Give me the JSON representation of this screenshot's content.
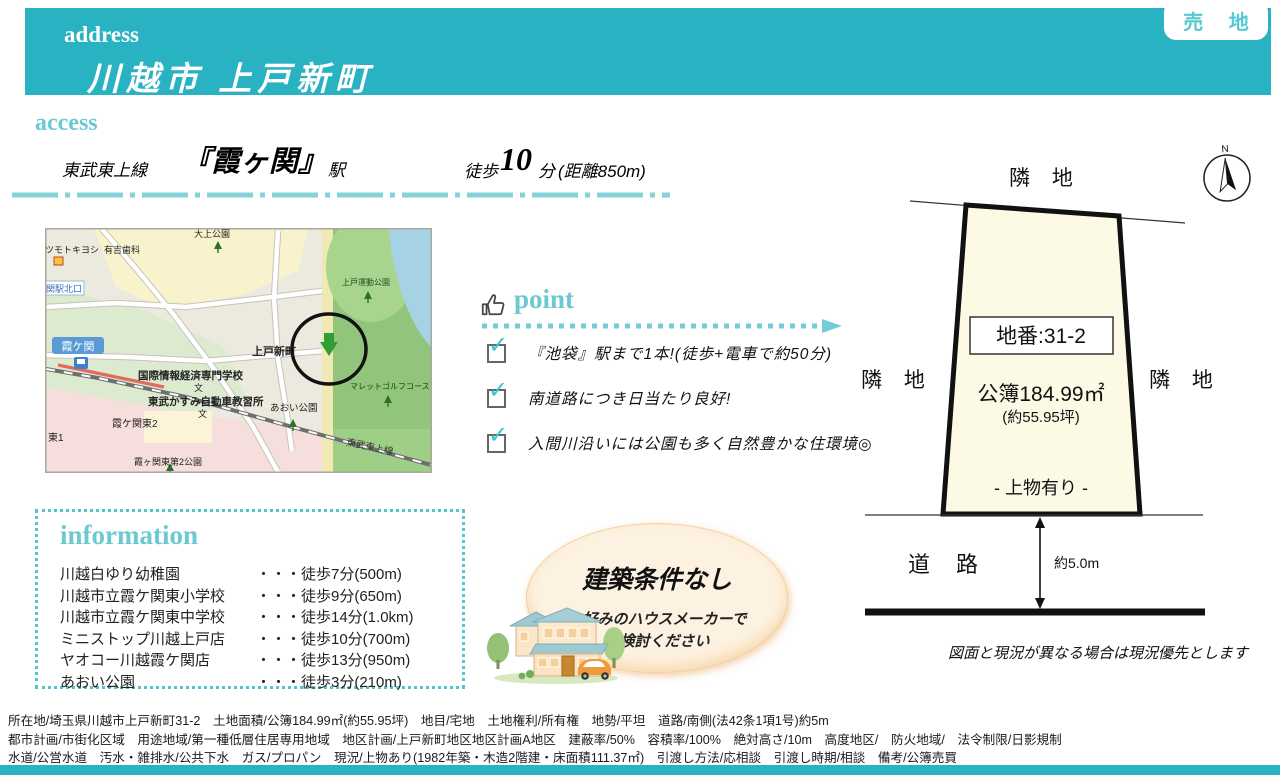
{
  "badge": {
    "text": "売 地"
  },
  "header": {
    "section_label": "address",
    "address": "川越市 上戸新町"
  },
  "access": {
    "section_label": "access",
    "rail_line": "東武東上線",
    "station": "『霞ヶ関』",
    "station_suffix": "駅",
    "walk_prefix": "徒歩",
    "walk_minutes": "10",
    "walk_unit": "分",
    "distance": "(距離850m)"
  },
  "map": {
    "drugstore": "マツモトキヨシ",
    "dental": "有吉歯科",
    "park_daijo": "大上公園",
    "park_sports": "上戸運動公園",
    "station_exit": "関駅北口",
    "station": "霞ケ関",
    "town": "上戸新町",
    "school1": "国際情報経済専門学校",
    "school2": "東武かすみ自動車教習所",
    "area1": "霞ケ関東2",
    "area2": "東1",
    "park_aoi": "あおい公園",
    "golf": "マレットゴルフコース",
    "park_no2": "霞ヶ関東第2公園",
    "rail": "東武東上線",
    "school_mark": "文"
  },
  "point": {
    "section_label": "point",
    "items": [
      "『池袋』駅まで1本!(徒歩+電車で約50分)",
      "南道路につき日当たり良好!",
      "入間川沿いには公園も多く自然豊かな住環境◎"
    ]
  },
  "information": {
    "section_label": "information",
    "items": [
      {
        "name": "川越白ゆり幼稚園",
        "distance": "・・・徒歩7分(500m)"
      },
      {
        "name": "川越市立霞ケ関東小学校",
        "distance": "・・・徒歩9分(650m)"
      },
      {
        "name": "川越市立霞ケ関東中学校",
        "distance": "・・・徒歩14分(1.0km)"
      },
      {
        "name": "ミニストップ川越上戸店",
        "distance": "・・・徒歩10分(700m)"
      },
      {
        "name": "ヤオコー川越霞ケ関店",
        "distance": "・・・徒歩13分(950m)"
      },
      {
        "name": "あおい公園",
        "distance": "・・・徒歩3分(210m)"
      }
    ]
  },
  "highlight": {
    "title": "建築条件なし",
    "subtitle1": "お好みのハウスメーカーで",
    "subtitle2": "ご検討ください"
  },
  "plot": {
    "adjacent_top": "隣 地",
    "adjacent_left": "隣 地",
    "adjacent_right": "隣 地",
    "lot_number": "地番:31-2",
    "area": "公簿184.99㎡",
    "area_tsubo": "(約55.95坪)",
    "building_note": "- 上物有り -",
    "road": "道 路",
    "road_width": "約5.0m",
    "compass": "N",
    "disclaimer": "図面と現況が異なる場合は現況優先とします"
  },
  "details": {
    "line1": "所在地/埼玉県川越市上戸新町31-2　土地面積/公簿184.99㎡(約55.95坪)　地目/宅地　土地権利/所有権　地勢/平坦　道路/南側(法42条1項1号)約5m",
    "line2": "都市計画/市街化区域　用途地域/第一種低層住居専用地域　地区計画/上戸新町地区地区計画A地区　建蔽率/50%　容積率/100%　絶対高さ/10m　高度地区/　防火地域/　法令制限/日影規制",
    "line3": "水道/公営水道　汚水・雑排水/公共下水　ガス/プロパン　現況/上物あり(1982年築・木造2階建・床面積111.37㎡)　引渡し方法/応相談　引渡し時期/相談　備考/公簿売買"
  },
  "icons": {
    "check_mark": "✓"
  },
  "colors": {
    "teal": "#29b2c1",
    "teal_light": "#6cc9d1",
    "plot_fill": "#fcf9e4",
    "highlight_fill": "#fdf2e1"
  }
}
